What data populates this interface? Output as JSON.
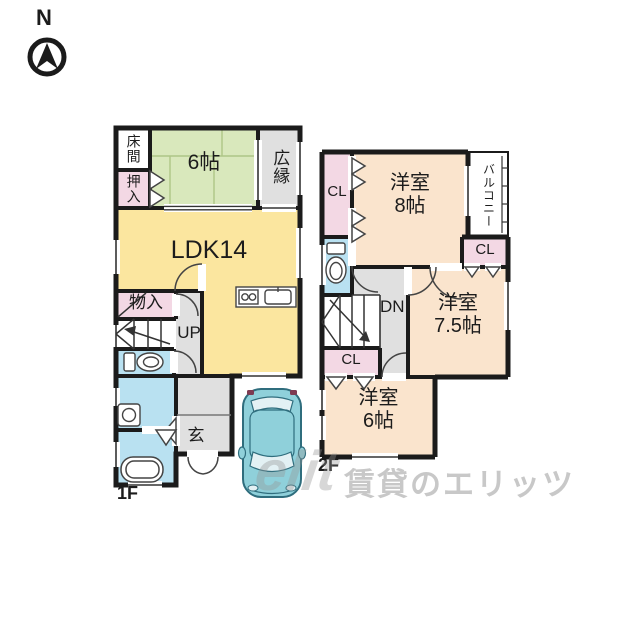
{
  "compass": {
    "north": "N"
  },
  "colors": {
    "wall": "#1b1b1b",
    "tatami_green": "#d9e8bc",
    "ldk_yellow": "#fbe69f",
    "closet_pink": "#f3d8e4",
    "wet_blue": "#b9e1f1",
    "western_peach": "#fae4cd",
    "hall_gray": "#e0e0e0",
    "car_teal": "#8fd0da",
    "car_outline": "#2f6d7d"
  },
  "floor1": {
    "floor_label": "1F",
    "tokonoma": "床間",
    "oshiire": "押入",
    "tatami_room": "6帖",
    "hiroen": "広縁",
    "ldk": "LDK14",
    "storage": "物入",
    "stairs": "UP",
    "entrance": "玄"
  },
  "floor2": {
    "floor_label": "2F",
    "closet_a": "CL",
    "closet_b": "CL",
    "closet_c": "CL",
    "balcony": "バルコニー",
    "stairs": "DN",
    "room8": {
      "name": "洋室",
      "size": "8帖"
    },
    "room75": {
      "name": "洋室",
      "size": "7.5帖"
    },
    "room6": {
      "name": "洋室",
      "size": "6帖"
    }
  },
  "watermark": {
    "logo": "elit",
    "text": "賃貸のエリッツ"
  }
}
